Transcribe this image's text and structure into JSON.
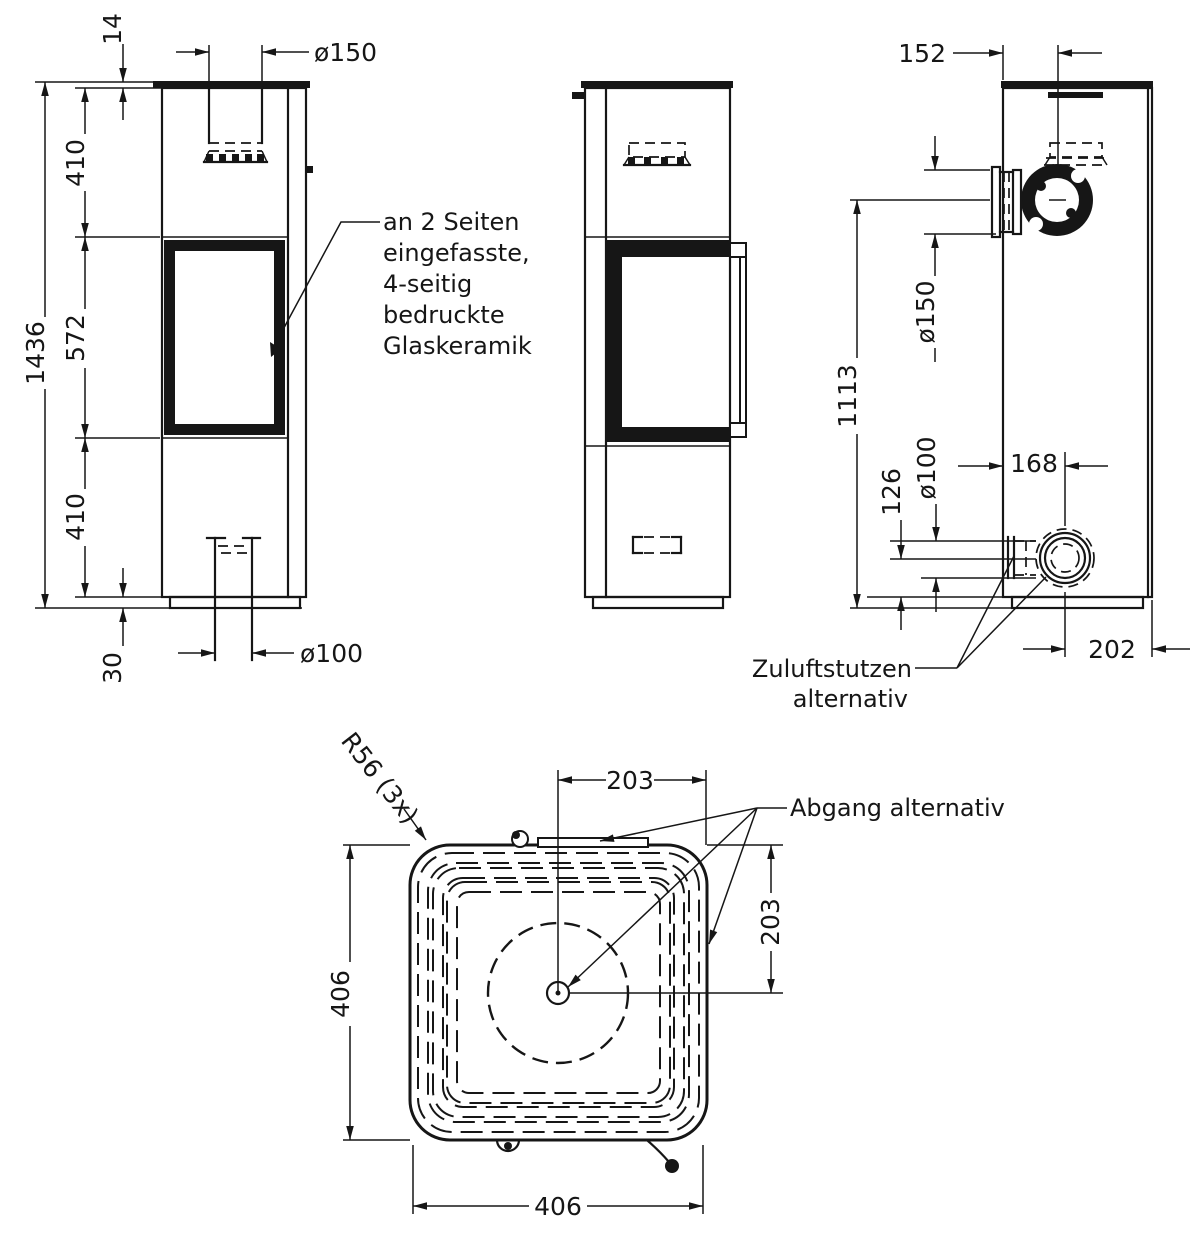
{
  "annotations": {
    "glass_note_lines": [
      "an 2 Seiten",
      "eingefasste,",
      "4-seitig",
      "bedruckte",
      "Glaskeramik"
    ],
    "zuluft_line1": "Zuluftstutzen",
    "zuluft_line2": "alternativ",
    "abgang_note": "Abgang alternativ",
    "radius_note": "R56 (3x)"
  },
  "dims": {
    "front": {
      "plate_thickness": "14",
      "flue_diameter": "ø150",
      "upper": "410",
      "window": "572",
      "lower": "410",
      "total_height": "1436",
      "plinth_height": "30",
      "air_diameter": "ø100"
    },
    "back": {
      "flue_offset": "152",
      "flue_diameter": "ø150",
      "flue_height": "1113",
      "air_height": "126",
      "air_diameter": "ø100",
      "air_offset": "168",
      "rear_offset": "202"
    },
    "top": {
      "half_width": "203",
      "half_depth": "203",
      "width": "406",
      "depth": "406"
    }
  },
  "colors": {
    "line": "#161616",
    "background": "#ffffff"
  }
}
